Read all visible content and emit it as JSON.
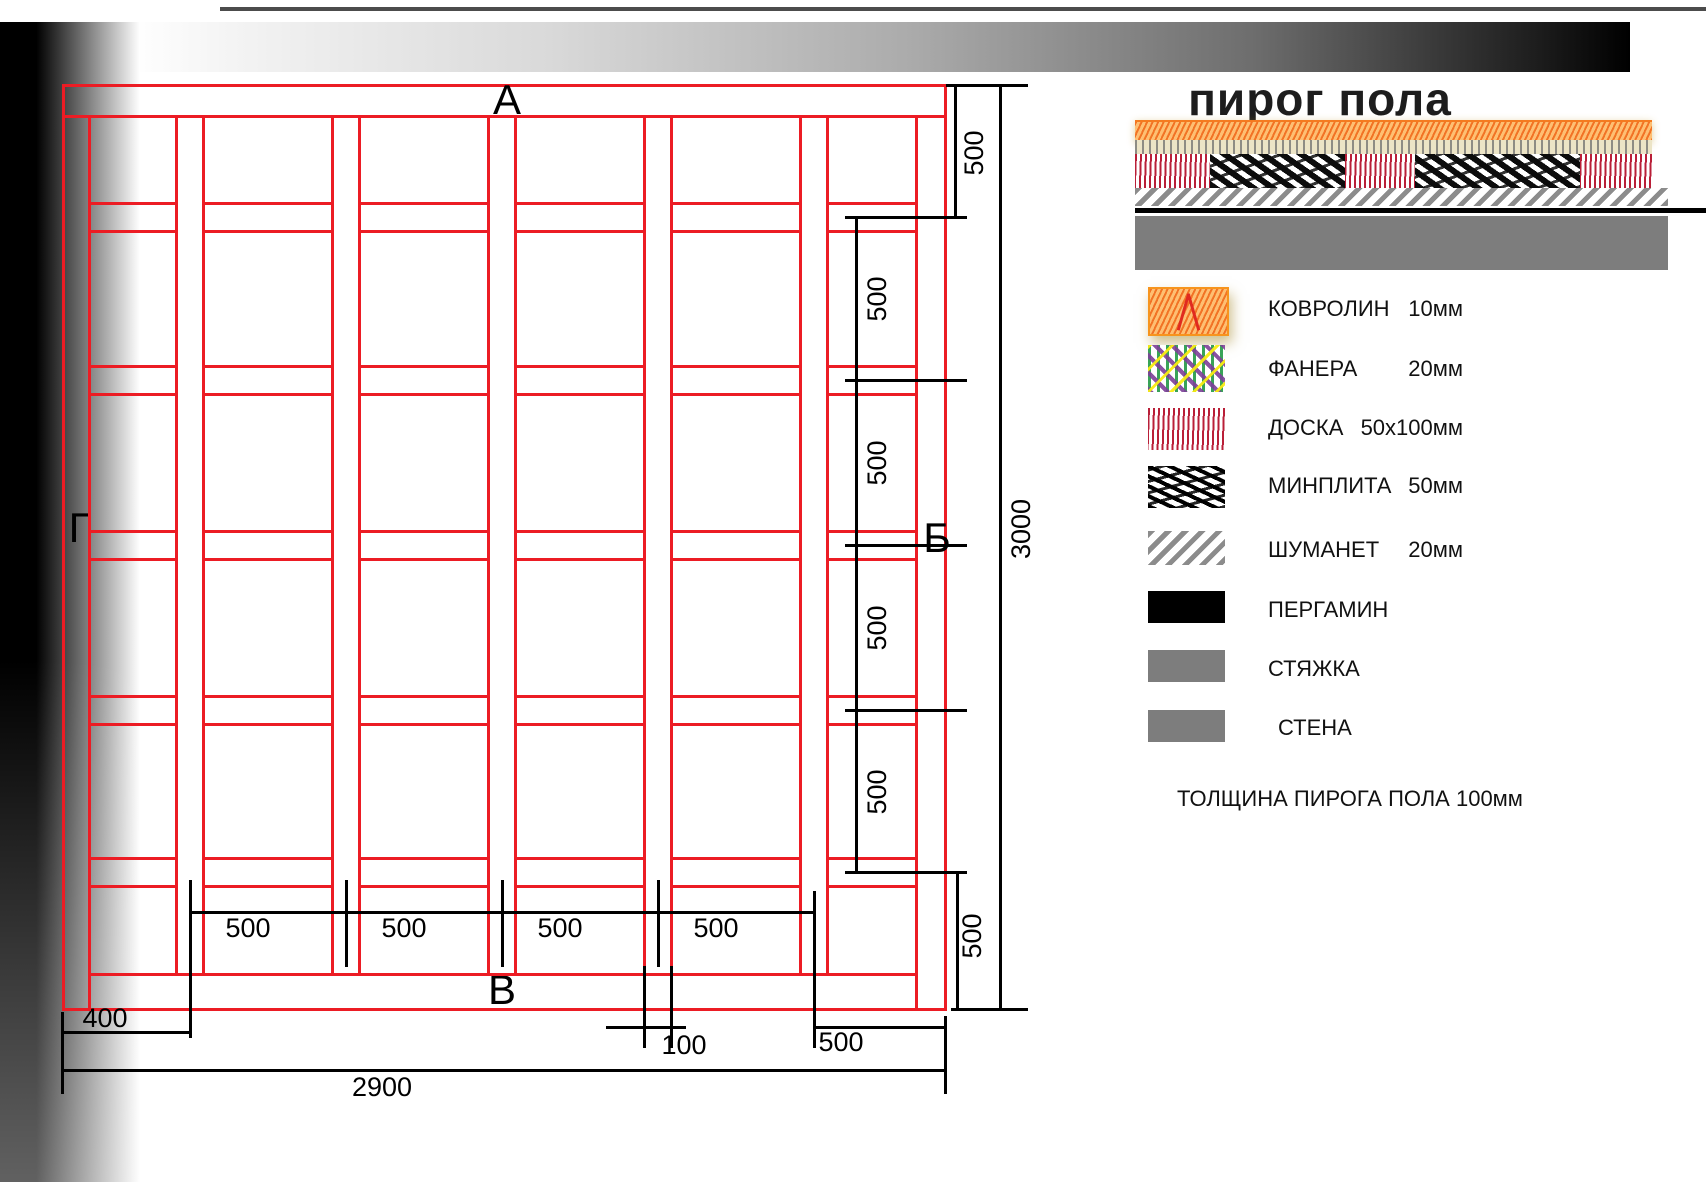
{
  "plan": {
    "axis_labels": {
      "top": "А",
      "right": "Б",
      "bottom": "В",
      "left": "Г"
    },
    "dims": {
      "right_top": "500",
      "right_chain": [
        "500",
        "500",
        "500",
        "500"
      ],
      "right_bottom": "500",
      "height_total": "3000",
      "bottom_chain": [
        "500",
        "500",
        "500",
        "500"
      ],
      "left_offset": "400",
      "joist_width": "100",
      "right_bay": "500",
      "width_total": "2900"
    }
  },
  "legend": {
    "title": "пирог пола",
    "items": [
      {
        "name": "КОВРОЛИН",
        "size": "10мм",
        "swatch": "carpet-orange-scribble"
      },
      {
        "name": "ФАНЕРА",
        "size": "20мм",
        "swatch": "plywood-color-scribble"
      },
      {
        "name": "ДОСКА",
        "size": "50х100мм",
        "swatch": "board-red-scribble"
      },
      {
        "name": "МИНПЛИТА",
        "size": "50мм",
        "swatch": "mineral-black-scribble"
      },
      {
        "name": "ШУМАНЕТ",
        "size": "20мм",
        "swatch": "gray-diagonal-hatch"
      },
      {
        "name": "ПЕРГАМИН",
        "size": "",
        "swatch": "solid-black"
      },
      {
        "name": "СТЯЖКА",
        "size": "",
        "swatch": "solid-gray"
      },
      {
        "name": "СТЕНА",
        "size": "",
        "swatch": "solid-gray"
      }
    ],
    "note": "ТОЛЩИНА ПИРОГА ПОЛА 100мм"
  },
  "colors": {
    "plan_red": "#ec1c24",
    "dim_black": "#000000",
    "screed_gray": "#7d7d7d"
  }
}
